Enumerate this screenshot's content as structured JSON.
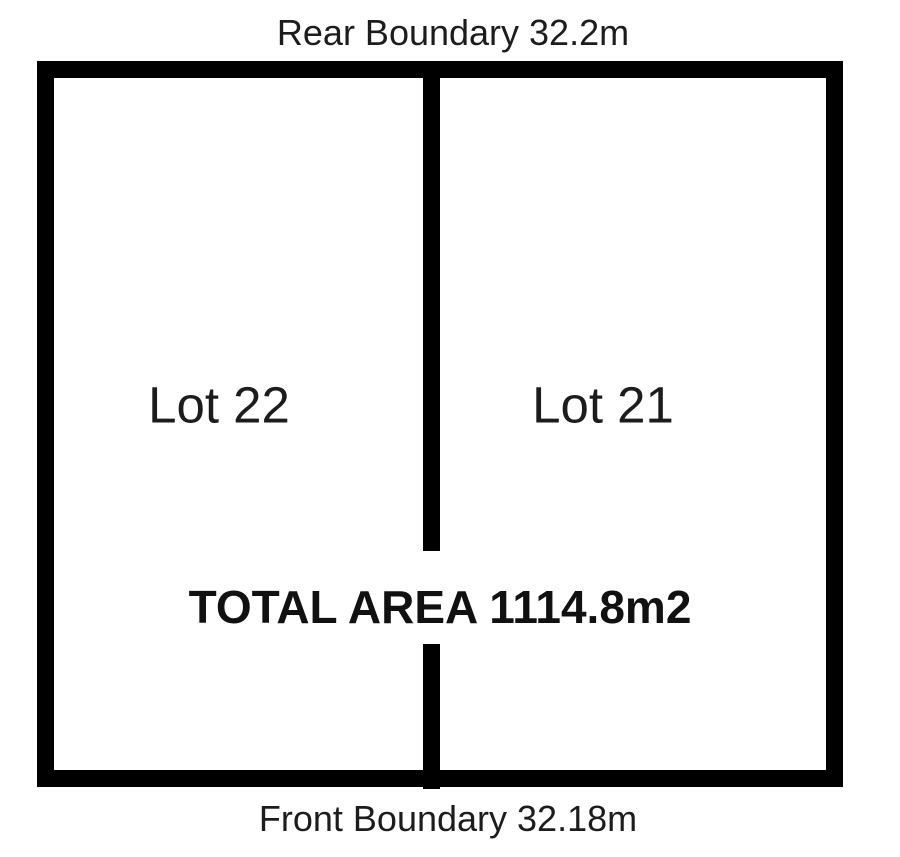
{
  "diagram": {
    "rear_boundary": {
      "label": "Rear Boundary 32.2m"
    },
    "front_boundary": {
      "label": "Front Boundary 32.18m"
    },
    "total_area": {
      "label": "TOTAL AREA 1114.8m2"
    },
    "lots": [
      {
        "label": "Lot 22"
      },
      {
        "label": "Lot 21"
      }
    ],
    "colors": {
      "outline": "#000000",
      "text": "#1c1c1c",
      "background": "#ffffff"
    }
  }
}
